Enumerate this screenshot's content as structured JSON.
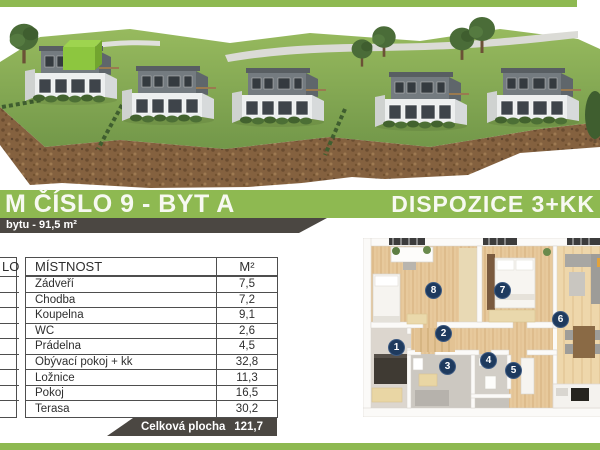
{
  "colors": {
    "accent_green": "#8eb951",
    "dark_bar": "#4b4742",
    "marker_navy": "#1e3a5e",
    "highlight_unit_green": "#8dc63f"
  },
  "header": {
    "title": "M ČÍSLO 9 - BYT A",
    "disposition": "DISPOZICE 3+KK",
    "area_note": "bytu - 91,5 m²"
  },
  "room_table": {
    "columns": {
      "number": "LO",
      "room": "MÍSTNOST",
      "area": "M²"
    },
    "rows": [
      {
        "name": "Zádveří",
        "area": "7,5"
      },
      {
        "name": "Chodba",
        "area": "7,2"
      },
      {
        "name": "Koupelna",
        "area": "9,1"
      },
      {
        "name": "WC",
        "area": "2,6"
      },
      {
        "name": "Prádelna",
        "area": "4,5"
      },
      {
        "name": "Obývací pokoj + kk",
        "area": "32,8"
      },
      {
        "name": "Ložnice",
        "area": "11,3"
      },
      {
        "name": "Pokoj",
        "area": "16,5"
      },
      {
        "name": "Terasa",
        "area": "30,2"
      }
    ],
    "footer": {
      "label": "Celková plocha",
      "value": "121,7"
    }
  },
  "floorplan": {
    "markers": [
      {
        "number": "1"
      },
      {
        "number": "2"
      },
      {
        "number": "3"
      },
      {
        "number": "4"
      },
      {
        "number": "5"
      },
      {
        "number": "6"
      },
      {
        "number": "7"
      },
      {
        "number": "8"
      }
    ]
  }
}
